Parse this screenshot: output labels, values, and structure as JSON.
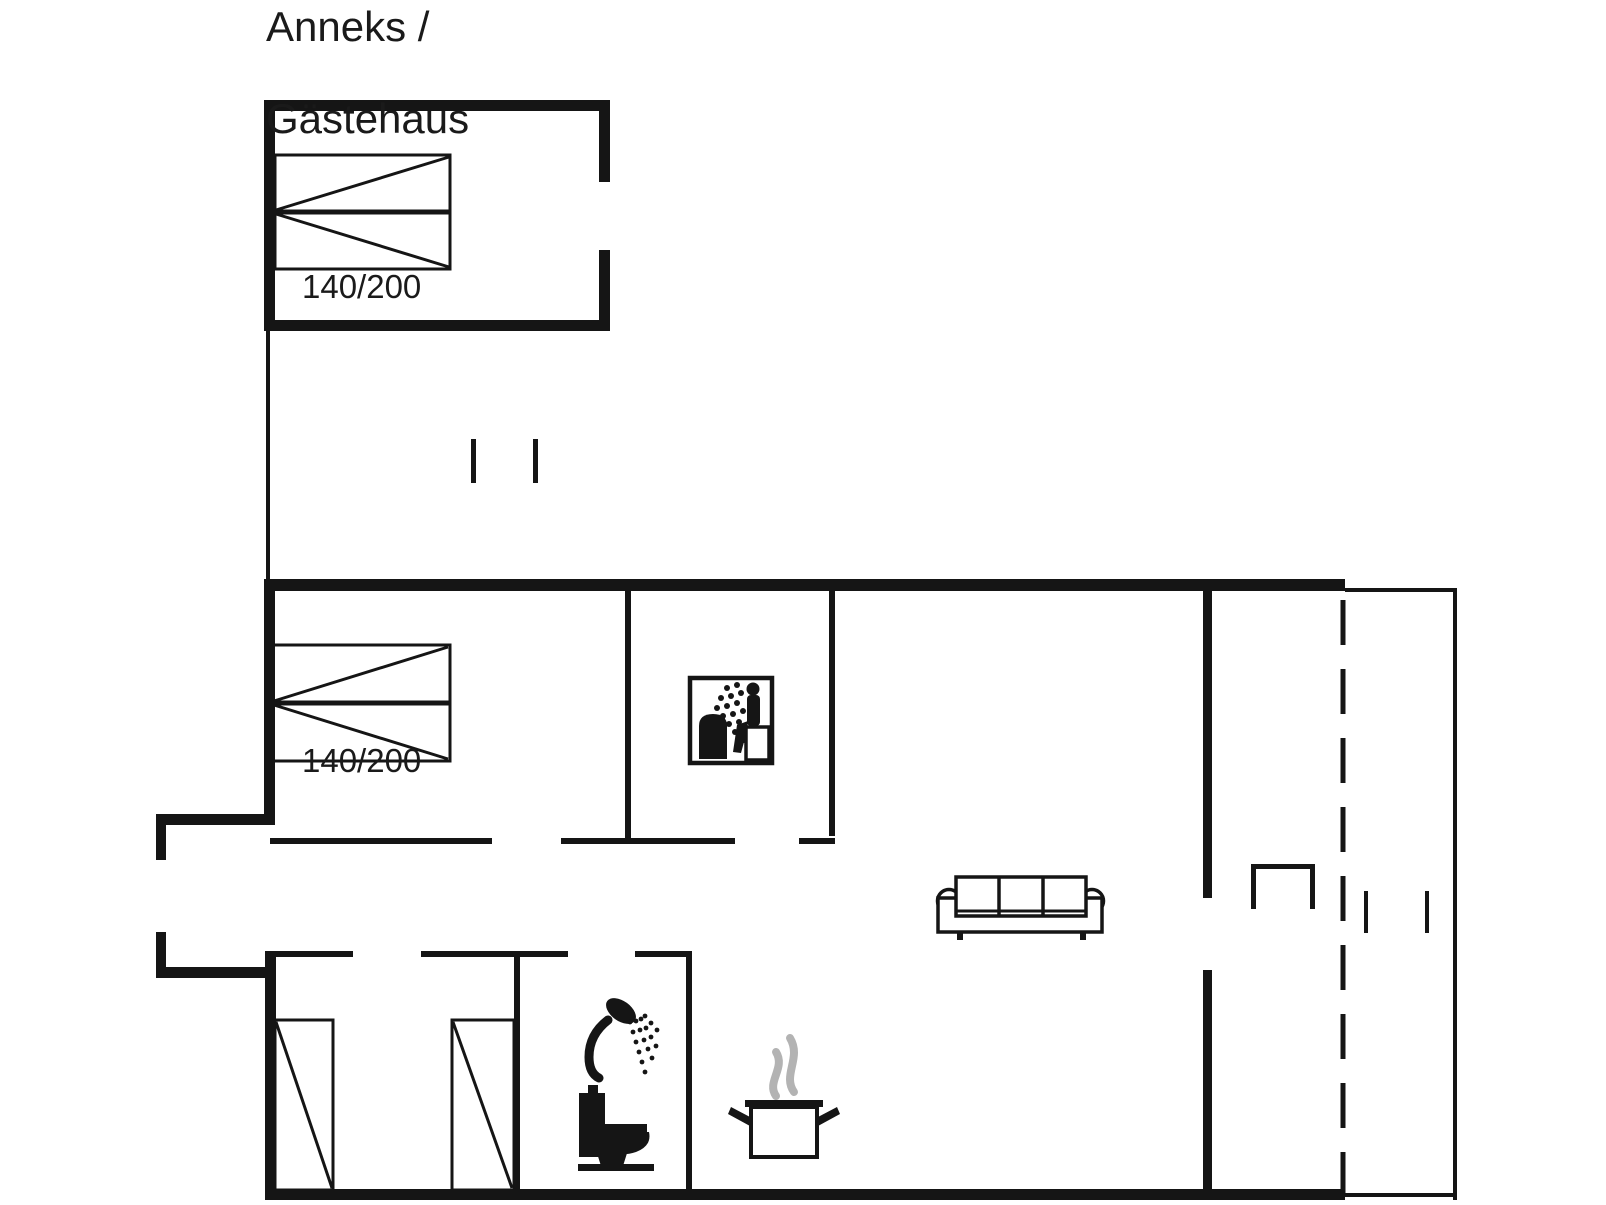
{
  "labels": {
    "annex_title_line1": "Anneks /",
    "annex_title_line2": "Gästehaus",
    "annex_bed_size": "140/200",
    "bedroom_bed_size": "140/200"
  },
  "colors": {
    "ink": "#151515",
    "background": "#ffffff",
    "steam_gray": "#b3b3b3"
  },
  "icons": {
    "double_bed": "double-bed-icon",
    "single_bed": "single-bed-icon",
    "sauna": "sauna-icon",
    "sofa": "sofa-icon",
    "shower": "shower-icon",
    "toilet": "toilet-icon",
    "cooking_pot": "cooking-pot-icon",
    "steam": "steam-icon"
  }
}
